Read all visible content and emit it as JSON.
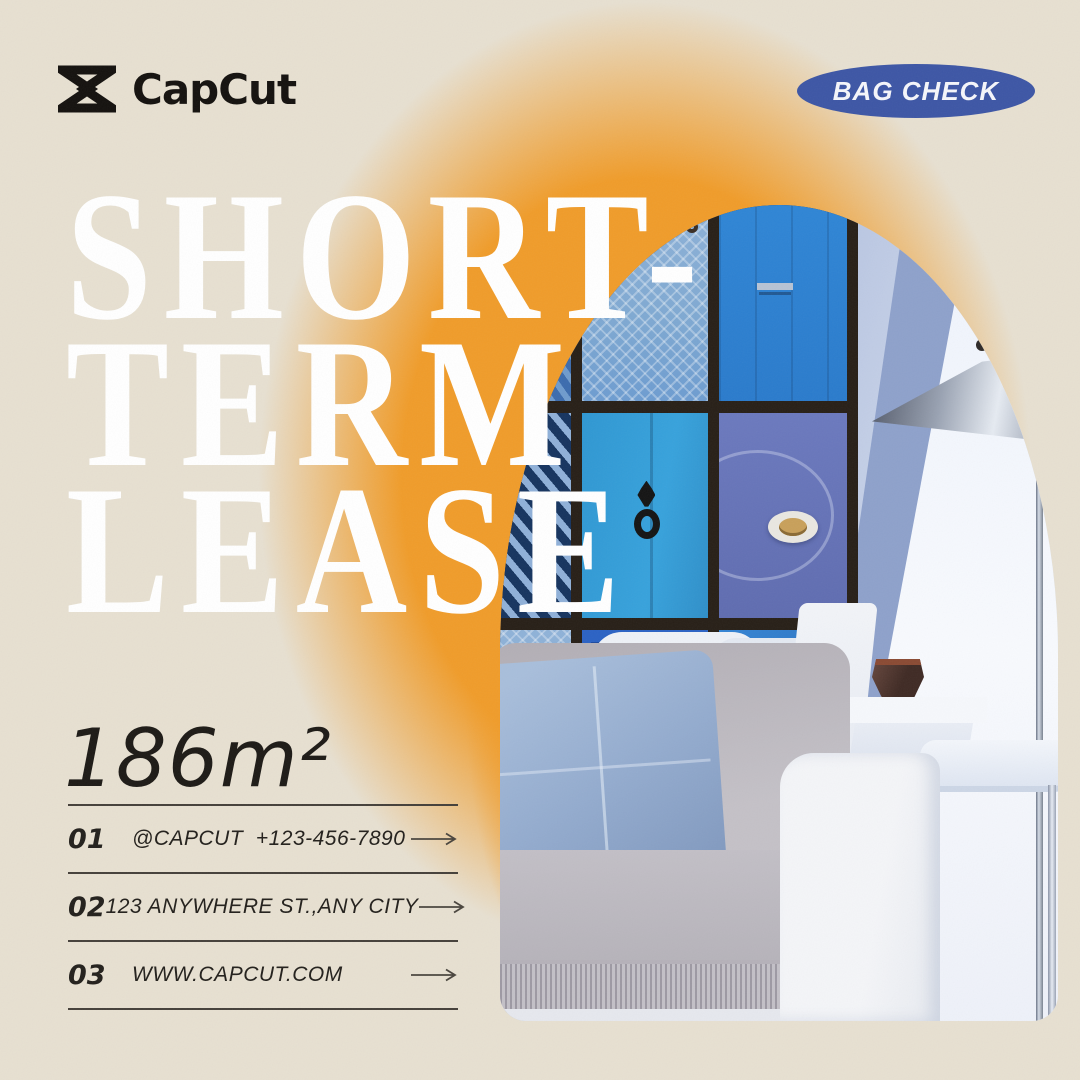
{
  "colors": {
    "background": "#e7e0d1",
    "glow": "#f09c2a",
    "ink": "#1d1a16",
    "line": "#45403a",
    "badge_bg": "#3d56a5",
    "badge_text": "#f5f6fb",
    "title": "#ffffff"
  },
  "header": {
    "brand": "CapCut",
    "badge_label": "BAG CHECK"
  },
  "icons": {
    "logo": "capcut-bowtie-mark",
    "row_arrow": "arrow-right"
  },
  "title": {
    "line1": "SHORT-",
    "line2": "TERM",
    "line3": "LEASE"
  },
  "stats": {
    "area": "186m²"
  },
  "contact_rows": [
    {
      "num": "01",
      "text": "@CAPCUT  +123-456-7890"
    },
    {
      "num": "02",
      "text": "123 ANYWHERE ST.,ANY CITY"
    },
    {
      "num": "03",
      "text": "WWW.CAPCUT.COM"
    }
  ]
}
